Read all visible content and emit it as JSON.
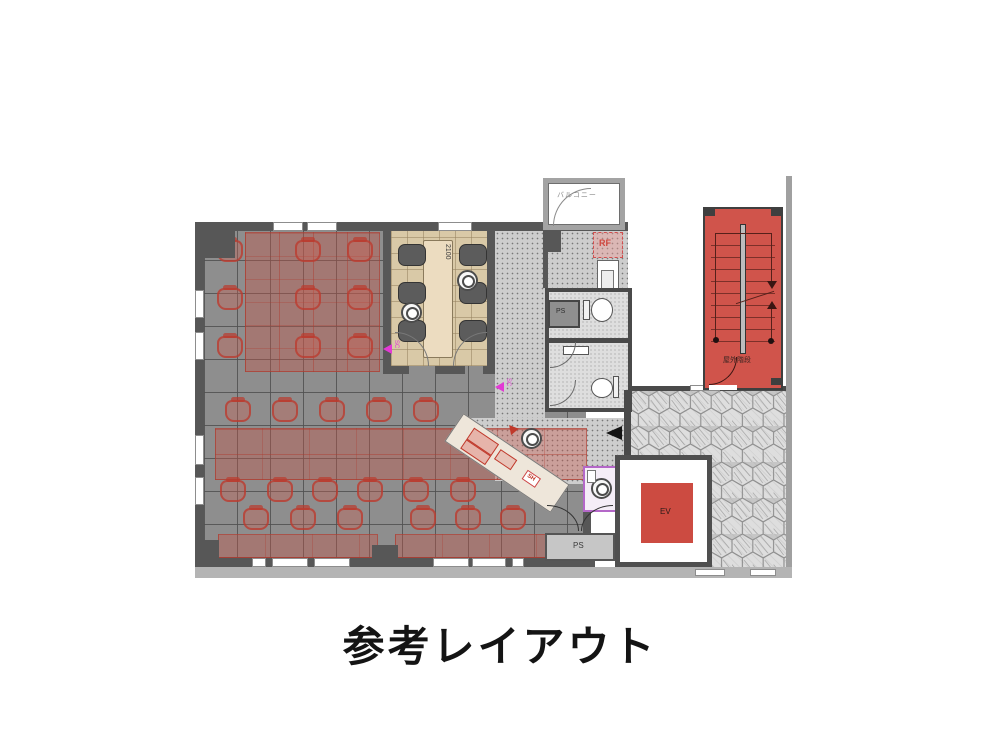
{
  "title": "参考レイアウト",
  "plan": {
    "balcony_label": "バルコニー",
    "fridge_label": "RF",
    "pipe_shaft_top_label": "PS",
    "pipe_shaft_bottom_label": "PS",
    "shelf_label": "SH",
    "elevator_label": "EV",
    "outdoor_stairs_label": "屋外階段",
    "meeting_table_dimension": "2100",
    "sensor_marker_1": "SC",
    "sensor_marker_2": "SC"
  },
  "icons": {
    "entry_arrow": "left-arrow",
    "sensor_markers": "magenta-triangle",
    "counter_marker": "red-triangle"
  },
  "colors": {
    "wall": "#575757",
    "office_floor": "#8e8e8e",
    "meeting_floor": "#d9c9a7",
    "desk_red": "#c65446",
    "stair_red": "#d0544b",
    "ev_red": "#cc4b41",
    "accent_magenta": "#e23ad4",
    "purple_room_border": "#b468c8",
    "paving": "#dedede"
  }
}
